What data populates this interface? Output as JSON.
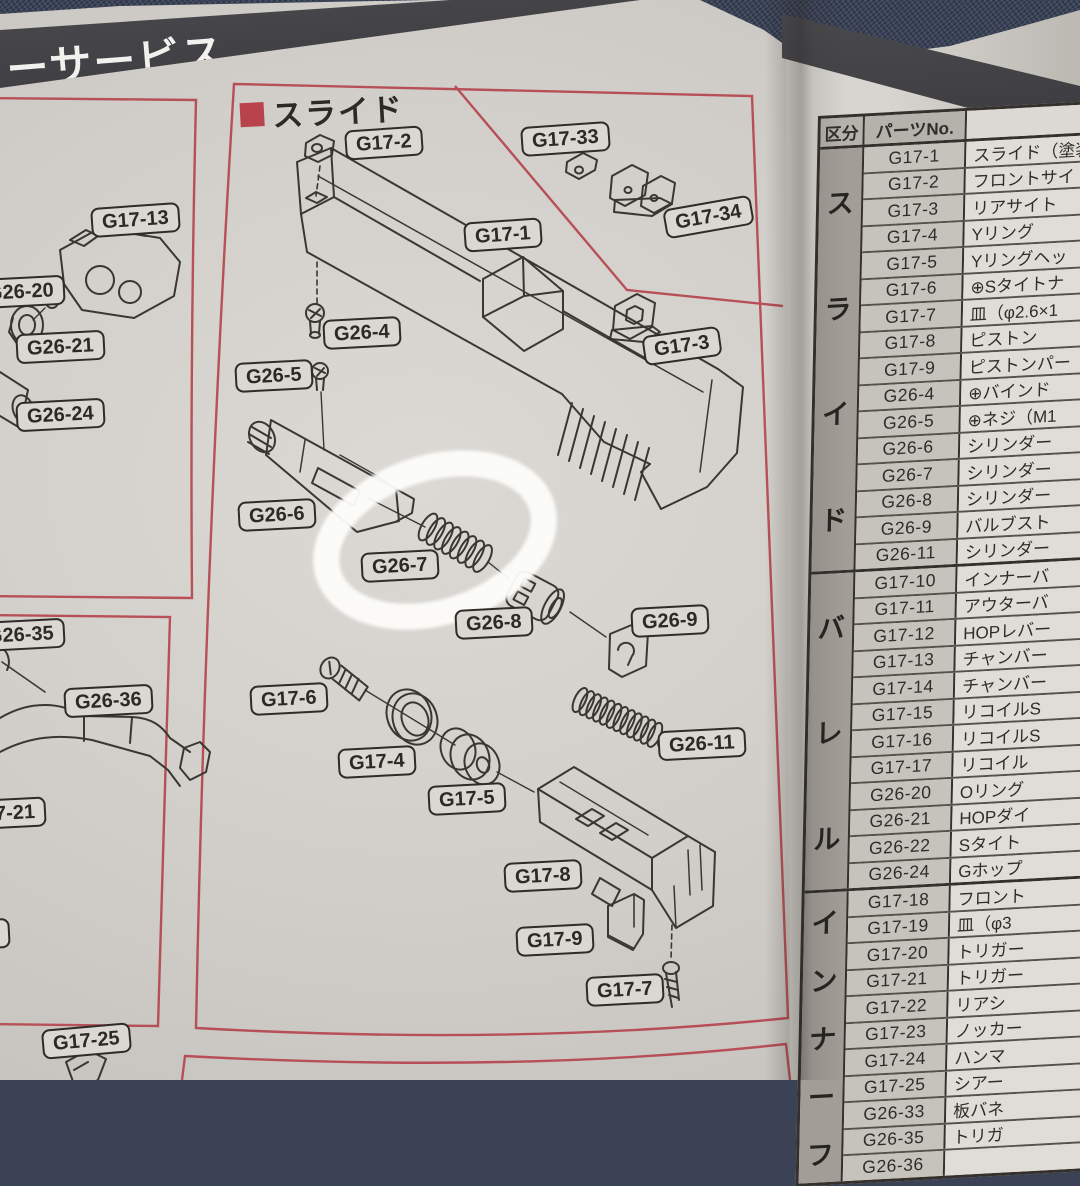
{
  "banner": {
    "title": "ーサービス"
  },
  "diagram": {
    "section_title": "スライド",
    "section_bullet_color": "#b8434c",
    "frame_color": "#b5454e",
    "labels": [
      {
        "text": "G17-2"
      },
      {
        "text": "G17-33"
      },
      {
        "text": "G17-34"
      },
      {
        "text": "G17-1"
      },
      {
        "text": "G17-3"
      },
      {
        "text": "G26-4"
      },
      {
        "text": "G26-5"
      },
      {
        "text": "G26-6"
      },
      {
        "text": "G26-7"
      },
      {
        "text": "G26-8"
      },
      {
        "text": "G26-9"
      },
      {
        "text": "G26-11"
      },
      {
        "text": "G17-6"
      },
      {
        "text": "G17-4"
      },
      {
        "text": "G17-5"
      },
      {
        "text": "G17-8"
      },
      {
        "text": "G17-9"
      },
      {
        "text": "G17-7"
      },
      {
        "text": "G17-13"
      },
      {
        "text": "G26-20"
      },
      {
        "text": "G26-21"
      },
      {
        "text": "G26-24"
      },
      {
        "text": "G26-35"
      },
      {
        "text": "G26-36"
      },
      {
        "text": "7-21"
      },
      {
        "text": "20"
      },
      {
        "text": "G17-25"
      }
    ],
    "annotation": {
      "shape": "hand-drawn-ellipse",
      "color": "#ffffff",
      "highlights": "G26-7"
    }
  },
  "table": {
    "headers": {
      "category": "区分",
      "part_no": "パーツNo.",
      "part_name": "パーツ名"
    },
    "sections": [
      {
        "category": "スライド",
        "rows": [
          [
            "G17-1",
            "スライド（塗装"
          ],
          [
            "G17-2",
            "フロントサイ"
          ],
          [
            "G17-3",
            "リアサイト"
          ],
          [
            "G17-4",
            "Yリング"
          ],
          [
            "G17-5",
            "Yリングヘッ"
          ],
          [
            "G17-6",
            "⊕Sタイトナ"
          ],
          [
            "G17-7",
            "皿（φ2.6×1"
          ],
          [
            "G17-8",
            "ピストン"
          ],
          [
            "G17-9",
            "ピストンパー"
          ],
          [
            "G26-4",
            "⊕バインド"
          ],
          [
            "G26-5",
            "⊕ネジ（M1"
          ],
          [
            "G26-6",
            "シリンダー"
          ],
          [
            "G26-7",
            "シリンダー"
          ],
          [
            "G26-8",
            "シリンダー"
          ],
          [
            "G26-9",
            "バルブスト"
          ],
          [
            "G26-11",
            "シリンダー"
          ]
        ]
      },
      {
        "category": "バレル",
        "rows": [
          [
            "G17-10",
            "インナーバ"
          ],
          [
            "G17-11",
            "アウターバ"
          ],
          [
            "G17-12",
            "HOPレバー"
          ],
          [
            "G17-13",
            "チャンバー"
          ],
          [
            "G17-14",
            "チャンバー"
          ],
          [
            "G17-15",
            "リコイルS"
          ],
          [
            "G17-16",
            "リコイルS"
          ],
          [
            "G17-17",
            "リコイル"
          ],
          [
            "G26-20",
            "Oリング"
          ],
          [
            "G26-21",
            "HOPダイ"
          ],
          [
            "G26-22",
            "Sタイト"
          ],
          [
            "G26-24",
            "Gホップ"
          ]
        ]
      },
      {
        "category": "インナーフ",
        "rows": [
          [
            "G17-18",
            "フロント"
          ],
          [
            "G17-19",
            "皿（φ3"
          ],
          [
            "G17-20",
            "トリガー"
          ],
          [
            "G17-21",
            "トリガー"
          ],
          [
            "G17-22",
            "リアシ"
          ],
          [
            "G17-23",
            "ノッカー"
          ],
          [
            "G17-24",
            "ハンマ"
          ],
          [
            "G17-25",
            "シアー"
          ],
          [
            "G26-33",
            "板バネ"
          ],
          [
            "G26-35",
            "トリガ"
          ],
          [
            "G26-36",
            ""
          ]
        ]
      }
    ]
  }
}
